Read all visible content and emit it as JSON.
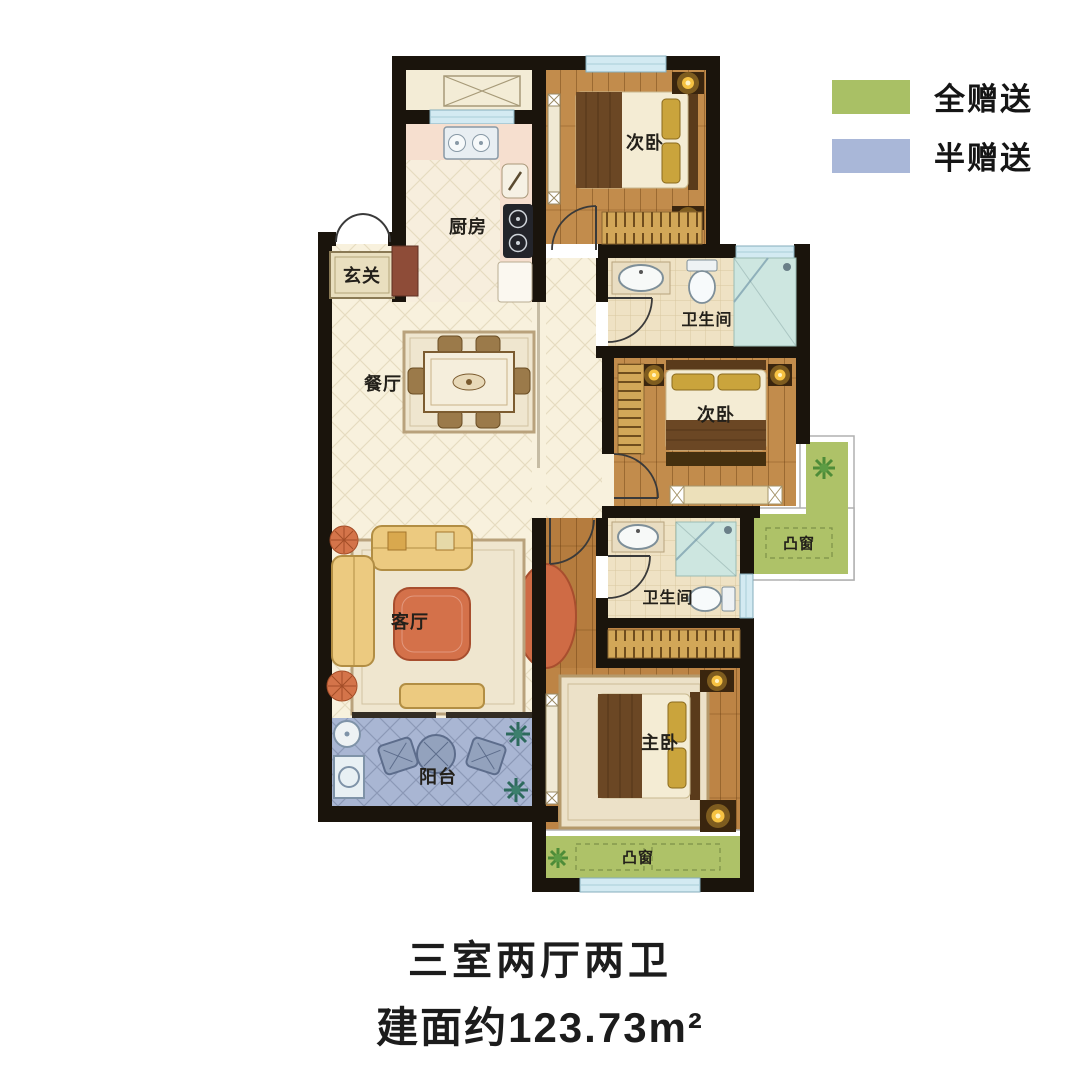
{
  "legend": {
    "items": [
      {
        "label": "全赠送",
        "color": "#a9c065"
      },
      {
        "label": "半赠送",
        "color": "#a9b7d8"
      }
    ]
  },
  "rooms": {
    "entry": "玄关",
    "kitchen": "厨房",
    "bedroom_top": "次卧",
    "bathroom_top": "卫生间",
    "dining": "餐厅",
    "bedroom_mid": "次卧",
    "bay_window_mid": "凸窗",
    "living": "客厅",
    "bathroom_bottom": "卫生间",
    "master_bedroom": "主卧",
    "balcony": "阳台",
    "bay_window_bottom": "凸窗"
  },
  "title": {
    "layout": "三室两厅两卫",
    "area": "建面约123.73m²"
  },
  "colors": {
    "full_gift_green": "#a9c065",
    "half_gift_blue": "#a9b7d8",
    "wall": "#1a140c",
    "wood_floor": "#c28c4c",
    "cream_floor": "#f8f1dd",
    "tile_floor": "#efe2c4",
    "window_glass": "#d3eaf2"
  }
}
